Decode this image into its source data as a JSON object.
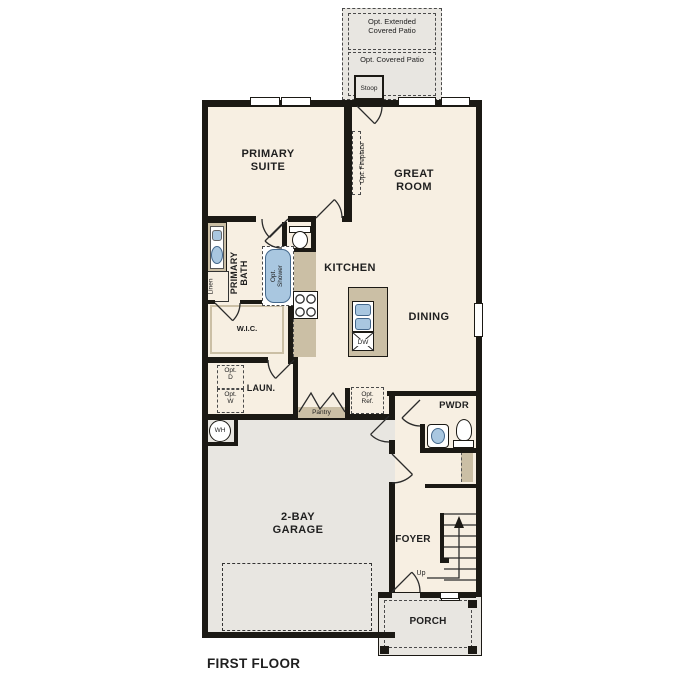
{
  "title": "FIRST FLOOR",
  "colors": {
    "floor": "#f7efe2",
    "concrete": "#e8e6e1",
    "cabinet": "#cbbfa5",
    "fixture_blue": "#a9c7e0",
    "wall": "#1b1914"
  },
  "labels": {
    "opt_extended_patio": "Opt. Extended\nCovered Patio",
    "opt_covered_patio": "Opt. Covered Patio",
    "stoop": "Stoop",
    "primary_suite": "PRIMARY\nSUITE",
    "great_room": "GREAT\nROOM",
    "opt_fireplace": "Opt. Fireplace",
    "primary_bath": "PRIMARY\nBATH",
    "linen": "Linen",
    "opt_shower": "Opt.\nShower",
    "wic": "W.I.C.",
    "kitchen": "KITCHEN",
    "dining": "DINING",
    "dw": "DW",
    "laundry": "LAUN.",
    "opt_dryer": "Opt.\nD",
    "opt_washer": "Opt.\nW",
    "pantry": "Pantry",
    "opt_ref": "Opt.\nRef.",
    "pwdr": "PWDR",
    "water_heater": "WH",
    "garage": "2-BAY\nGARAGE",
    "foyer": "FOYER",
    "up": "Up",
    "porch": "PORCH",
    "first_floor": "FIRST FLOOR"
  }
}
